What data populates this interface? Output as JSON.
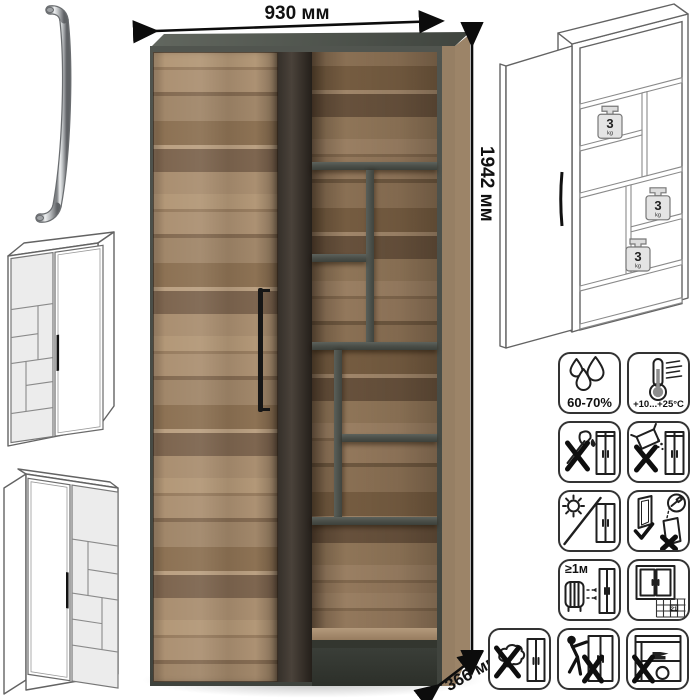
{
  "dimensions": {
    "width": "930 мм",
    "height": "1942 мм",
    "depth": "366 мм"
  },
  "shelf_load": {
    "value": "3",
    "unit": "kg"
  },
  "care": {
    "humidity": "60-70%",
    "temperature": "+10...+25°C",
    "min_heat_distance": "≥1м",
    "acclimation_days": "21"
  },
  "colors": {
    "wood": "#a98e71",
    "carcass": "#4c504c",
    "handle_black": "#1a1a1a",
    "line_art": "#606060",
    "dimension_text": "#111111"
  }
}
